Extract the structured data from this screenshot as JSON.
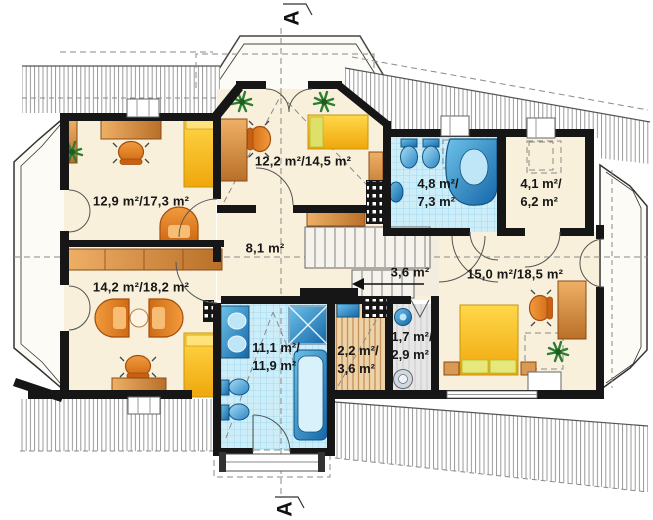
{
  "section": {
    "top_label": "A",
    "bottom_label": "A"
  },
  "rooms": {
    "bedroom_top_left": {
      "area": "12,9 m²/17,3 m²"
    },
    "bedroom_bottom_left": {
      "area": "14,2 m²/18,2 m²"
    },
    "bedroom_top_center": {
      "area": "12,2 m²/14,5 m²"
    },
    "hall": {
      "area": "8,1 m²"
    },
    "landing": {
      "area": "3,6 m²"
    },
    "bathroom_top": {
      "line1": "4,8 m²/",
      "line2": "7,3  m²"
    },
    "wardrobe": {
      "line1": "4,1 m²/",
      "line2": "6,2  m²"
    },
    "bedroom_right": {
      "area": "15,0 m²/18,5 m²"
    },
    "bathroom_bottom": {
      "line1": "11,1 m²/",
      "line2": "11,9  m²"
    },
    "sauna": {
      "line1": "2,2 m²/",
      "line2": "3,6  m²"
    },
    "shower_room": {
      "line1": "1,7 m²/",
      "line2": "2,9  m²"
    }
  },
  "colors": {
    "wall": "#161616",
    "floor_cream": "#f8f0db",
    "tile_blue": "#cdeef9",
    "fixture_blue": "#2a85c4",
    "furniture_orange": "#e08a3c",
    "bed_yellow": "#f8c51f",
    "sauna_wood": "#eed3a8",
    "roof_hatch": "#8e8e8e",
    "dashed_line": "#8a8a8a"
  }
}
